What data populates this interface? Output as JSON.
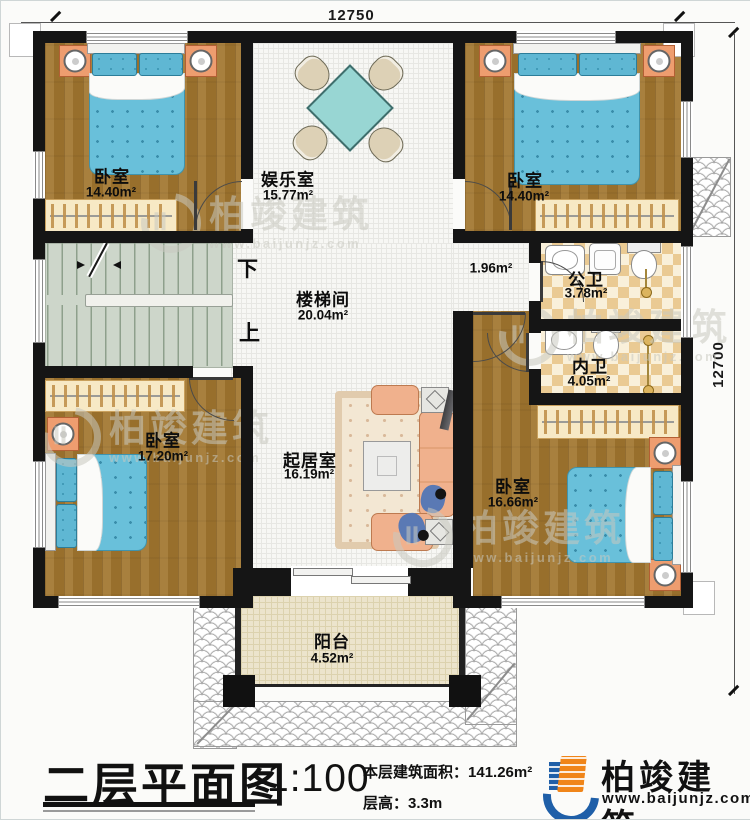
{
  "meta": {
    "plan_title": "二层平面图",
    "scale": "1:100",
    "area_label": "本层建筑面积：",
    "area_value": "141.26m²",
    "height_label": "层高：",
    "height_value": "3.3m",
    "brand": "柏竣建筑",
    "website": "www.baijunjz.com"
  },
  "dimensions": {
    "top": "12750",
    "right": "12700"
  },
  "stairs": {
    "down": "下",
    "up": "上"
  },
  "watermark": {
    "brand": "柏竣建筑",
    "site": "www.baijunjz.com"
  },
  "rooms": [
    {
      "id": "bedroom-nw",
      "name": "卧室",
      "area": "14.40m²"
    },
    {
      "id": "entertainment",
      "name": "娱乐室",
      "area": "15.77m²"
    },
    {
      "id": "bedroom-ne",
      "name": "卧室",
      "area": "14.40m²"
    },
    {
      "id": "stairwell",
      "name": "楼梯间",
      "area": "20.04m²"
    },
    {
      "id": "hallway",
      "name": "",
      "area": "1.96m²"
    },
    {
      "id": "public-bath",
      "name": "公卫",
      "area": "3.78m²"
    },
    {
      "id": "private-bath",
      "name": "内卫",
      "area": "4.05m²"
    },
    {
      "id": "bedroom-w",
      "name": "卧室",
      "area": "17.20m²"
    },
    {
      "id": "living",
      "name": "起居室",
      "area": "16.19m²"
    },
    {
      "id": "bedroom-se",
      "name": "卧室",
      "area": "16.66m²"
    },
    {
      "id": "balcony",
      "name": "阳台",
      "area": "4.52m²"
    }
  ],
  "colors": {
    "wall": "#151515",
    "wood_floor": "#a1762f",
    "bath_tile": "#eaca93",
    "stairs": "#cdd6ca",
    "bed_teal": "#69c0da",
    "furniture_salmon": "#f0b18d",
    "balcony": "#ece4cc",
    "brand_orange": "#f08519",
    "brand_blue": "#1f5fa8"
  }
}
